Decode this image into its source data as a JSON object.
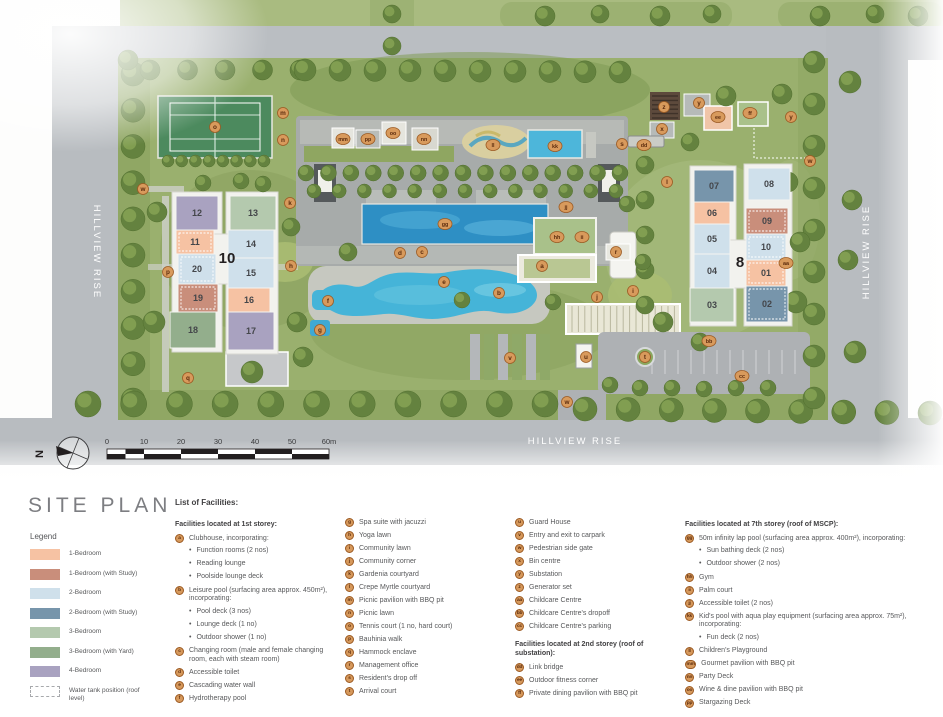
{
  "title": "SITE PLAN",
  "plan": {
    "roads": {
      "left": "HILLVIEW RISE",
      "right": "HILLVIEW RISE",
      "bottom": "HILLVIEW RISE"
    },
    "north_label": "N",
    "scale_labels": [
      "0",
      "10",
      "20",
      "30",
      "40",
      "50",
      "60m"
    ],
    "colors": {
      "b1": "#f6c2a3",
      "b1s": "#c98e7b",
      "b2": "#cfe0eb",
      "b2s": "#7795ab",
      "b3": "#b4c9ae",
      "b3y": "#93ae8c",
      "b4": "#a9a2c0",
      "marker_bg": "#d89a5c",
      "marker_border": "#9c5a22",
      "marker_text": "#5c2c0e",
      "pool": "#45b4d8",
      "lap_pool": "#2e8fc4"
    },
    "blocks": [
      {
        "label": "10",
        "x": 227,
        "y": 263
      },
      {
        "label": "8",
        "x": 740,
        "y": 267
      }
    ],
    "units": [
      {
        "label": "12",
        "x": 176,
        "y": 196,
        "w": 42,
        "h": 34,
        "c": "b4"
      },
      {
        "label": "13",
        "x": 230,
        "y": 196,
        "w": 46,
        "h": 34,
        "c": "b3"
      },
      {
        "label": "11",
        "x": 176,
        "y": 230,
        "w": 38,
        "h": 24,
        "c": "b1",
        "dashed": true
      },
      {
        "label": "14",
        "x": 228,
        "y": 230,
        "w": 46,
        "h": 28,
        "c": "b2"
      },
      {
        "label": "20",
        "x": 178,
        "y": 254,
        "w": 38,
        "h": 30,
        "c": "b2",
        "dashed": true
      },
      {
        "label": "15",
        "x": 228,
        "y": 258,
        "w": 46,
        "h": 30,
        "c": "b2"
      },
      {
        "label": "19",
        "x": 178,
        "y": 284,
        "w": 40,
        "h": 28,
        "c": "b1s",
        "dashed": true
      },
      {
        "label": "16",
        "x": 228,
        "y": 288,
        "w": 42,
        "h": 24,
        "c": "b1"
      },
      {
        "label": "18",
        "x": 170,
        "y": 312,
        "w": 46,
        "h": 36,
        "c": "b3y"
      },
      {
        "label": "17",
        "x": 228,
        "y": 312,
        "w": 46,
        "h": 38,
        "c": "b4"
      },
      {
        "label": "07",
        "x": 694,
        "y": 170,
        "w": 40,
        "h": 32,
        "c": "b2s"
      },
      {
        "label": "08",
        "x": 748,
        "y": 168,
        "w": 42,
        "h": 32,
        "c": "b2"
      },
      {
        "label": "06",
        "x": 694,
        "y": 202,
        "w": 36,
        "h": 22,
        "c": "b1"
      },
      {
        "label": "09",
        "x": 746,
        "y": 208,
        "w": 42,
        "h": 26,
        "c": "b1s",
        "dashed": true
      },
      {
        "label": "05",
        "x": 694,
        "y": 224,
        "w": 36,
        "h": 30,
        "c": "b2"
      },
      {
        "label": "10",
        "x": 746,
        "y": 234,
        "w": 40,
        "h": 26,
        "c": "b2",
        "dashed": true
      },
      {
        "label": "04",
        "x": 694,
        "y": 254,
        "w": 36,
        "h": 34,
        "c": "b2"
      },
      {
        "label": "01",
        "x": 746,
        "y": 260,
        "w": 40,
        "h": 26,
        "c": "b1",
        "dashed": true
      },
      {
        "label": "03",
        "x": 690,
        "y": 288,
        "w": 44,
        "h": 34,
        "c": "b3"
      },
      {
        "label": "02",
        "x": 746,
        "y": 286,
        "w": 42,
        "h": 36,
        "c": "b2s",
        "dashed": true
      }
    ],
    "markers": [
      {
        "id": "o",
        "x": 215,
        "y": 127
      },
      {
        "id": "m",
        "x": 283,
        "y": 113
      },
      {
        "id": "n",
        "x": 283,
        "y": 140
      },
      {
        "id": "w",
        "x": 143,
        "y": 189
      },
      {
        "id": "k",
        "x": 290,
        "y": 203
      },
      {
        "id": "p",
        "x": 168,
        "y": 272
      },
      {
        "id": "h",
        "x": 291,
        "y": 266
      },
      {
        "id": "q",
        "x": 188,
        "y": 378
      },
      {
        "id": "mm",
        "x": 343,
        "y": 139
      },
      {
        "id": "pp",
        "x": 368,
        "y": 139
      },
      {
        "id": "oo",
        "x": 393,
        "y": 133
      },
      {
        "id": "nn",
        "x": 424,
        "y": 139
      },
      {
        "id": "ll",
        "x": 493,
        "y": 145
      },
      {
        "id": "kk",
        "x": 555,
        "y": 146
      },
      {
        "id": "gg",
        "x": 445,
        "y": 224
      },
      {
        "id": "jj",
        "x": 566,
        "y": 207
      },
      {
        "id": "hh",
        "x": 557,
        "y": 237
      },
      {
        "id": "ii",
        "x": 582,
        "y": 237
      },
      {
        "id": "d",
        "x": 400,
        "y": 253
      },
      {
        "id": "c",
        "x": 422,
        "y": 252
      },
      {
        "id": "a",
        "x": 542,
        "y": 266
      },
      {
        "id": "e",
        "x": 444,
        "y": 282
      },
      {
        "id": "r",
        "x": 616,
        "y": 252
      },
      {
        "id": "f",
        "x": 328,
        "y": 301
      },
      {
        "id": "g",
        "x": 320,
        "y": 330
      },
      {
        "id": "b",
        "x": 499,
        "y": 293
      },
      {
        "id": "j",
        "x": 597,
        "y": 297
      },
      {
        "id": "v",
        "x": 510,
        "y": 358
      },
      {
        "id": "u",
        "x": 586,
        "y": 357
      },
      {
        "id": "t",
        "x": 645,
        "y": 357
      },
      {
        "id": "bb",
        "x": 709,
        "y": 341
      },
      {
        "id": "cc",
        "x": 742,
        "y": 376
      },
      {
        "id": "w",
        "x": 567,
        "y": 402
      },
      {
        "id": "z",
        "x": 664,
        "y": 107
      },
      {
        "id": "y",
        "x": 699,
        "y": 103
      },
      {
        "id": "ee",
        "x": 718,
        "y": 117
      },
      {
        "id": "ff",
        "x": 750,
        "y": 113
      },
      {
        "id": "y",
        "x": 791,
        "y": 117
      },
      {
        "id": "x",
        "x": 662,
        "y": 129
      },
      {
        "id": "dd",
        "x": 644,
        "y": 145
      },
      {
        "id": "s",
        "x": 622,
        "y": 144
      },
      {
        "id": "l",
        "x": 667,
        "y": 182
      },
      {
        "id": "i",
        "x": 633,
        "y": 291
      },
      {
        "id": "aa",
        "x": 786,
        "y": 263
      },
      {
        "id": "w",
        "x": 810,
        "y": 161
      }
    ]
  },
  "legend": {
    "title": "Legend",
    "items": [
      {
        "label": "1-Bedroom",
        "color": "#f6c2a3"
      },
      {
        "label": "1-Bedroom (with Study)",
        "color": "#c98e7b"
      },
      {
        "label": "2-Bedroom",
        "color": "#cfe0eb"
      },
      {
        "label": "2-Bedroom (with Study)",
        "color": "#7795ab"
      },
      {
        "label": "3-Bedroom",
        "color": "#b4c9ae"
      },
      {
        "label": "3-Bedroom (with Yard)",
        "color": "#93ae8c"
      },
      {
        "label": "4-Bedroom",
        "color": "#a9a2c0"
      },
      {
        "label": "Water tank position (roof level)",
        "color": "#ffffff",
        "dashed": true
      }
    ]
  },
  "facilities": {
    "title": "List of Facilities:",
    "columns": [
      {
        "entries": [
          {
            "h": "Facilities located at 1st storey:"
          },
          {
            "id": "a",
            "t": "Clubhouse, incorporating:",
            "b": [
              "Function rooms (2 nos)",
              "Reading lounge",
              "Poolside lounge deck"
            ]
          },
          {
            "id": "b",
            "t": "Leisure pool (surfacing area approx. 450m²), incorporating:",
            "b": [
              "Pool deck (3 nos)",
              "Lounge deck (1 no)",
              "Outdoor shower (1 no)"
            ]
          },
          {
            "id": "c",
            "t": "Changing room (male and female changing room, each with steam room)"
          },
          {
            "id": "d",
            "t": "Accessible toilet"
          },
          {
            "id": "e",
            "t": "Cascading water wall"
          },
          {
            "id": "f",
            "t": "Hydrotherapy pool"
          }
        ]
      },
      {
        "entries": [
          {
            "id": "g",
            "t": "Spa suite with jacuzzi"
          },
          {
            "id": "h",
            "t": "Yoga lawn"
          },
          {
            "id": "i",
            "t": "Community lawn"
          },
          {
            "id": "j",
            "t": "Community corner"
          },
          {
            "id": "k",
            "t": "Gardenia courtyard"
          },
          {
            "id": "l",
            "t": "Crepe Myrtle courtyard"
          },
          {
            "id": "m",
            "t": "Picnic pavilion with BBQ pit"
          },
          {
            "id": "n",
            "t": "Picnic lawn"
          },
          {
            "id": "o",
            "t": "Tennis court (1 no, hard court)"
          },
          {
            "id": "p",
            "t": "Bauhinia walk"
          },
          {
            "id": "q",
            "t": "Hammock enclave"
          },
          {
            "id": "r",
            "t": "Management office"
          },
          {
            "id": "s",
            "t": "Resident's drop off"
          },
          {
            "id": "t",
            "t": "Arrival court"
          }
        ]
      },
      {
        "entries": [
          {
            "id": "u",
            "t": "Guard House"
          },
          {
            "id": "v",
            "t": "Entry and exit to carpark"
          },
          {
            "id": "w",
            "t": "Pedestrian side gate"
          },
          {
            "id": "x",
            "t": "Bin centre"
          },
          {
            "id": "y",
            "t": "Substation"
          },
          {
            "id": "z",
            "t": "Generator set"
          },
          {
            "id": "aa",
            "t": "Childcare Centre"
          },
          {
            "id": "bb",
            "t": "Childcare Centre's dropoff"
          },
          {
            "id": "cc",
            "t": "Childcare Centre's parking"
          },
          {
            "h": "Facilities located at 2nd storey (roof of substation):"
          },
          {
            "id": "dd",
            "t": "Link bridge"
          },
          {
            "id": "ee",
            "t": "Outdoor fitness corner"
          },
          {
            "id": "ff",
            "t": "Private dining pavilion with BBQ pit"
          }
        ]
      },
      {
        "entries": [
          {
            "h": "Facilities located at 7th storey (roof of MSCP):"
          },
          {
            "id": "gg",
            "t": "50m infinity lap pool (surfacing area approx. 400m²), incorporating:",
            "b": [
              "Sun bathing deck (2 nos)",
              "Outdoor shower (2 nos)"
            ]
          },
          {
            "id": "hh",
            "t": "Gym"
          },
          {
            "id": "ii",
            "t": "Palm court"
          },
          {
            "id": "jj",
            "t": "Accessible toilet (2 nos)"
          },
          {
            "id": "kk",
            "t": "Kid's pool with aqua play equipment (surfacing area approx. 75m²), incorporating:",
            "b": [
              "Fun deck (2 nos)"
            ]
          },
          {
            "id": "ll",
            "t": "Children's Playground"
          },
          {
            "id": "mm",
            "t": "Gourmet pavilion with BBQ pit"
          },
          {
            "id": "nn",
            "t": "Party Deck"
          },
          {
            "id": "oo",
            "t": "Wine & dine pavilion with BBQ pit"
          },
          {
            "id": "pp",
            "t": "Stargazing Deck"
          }
        ]
      }
    ]
  }
}
